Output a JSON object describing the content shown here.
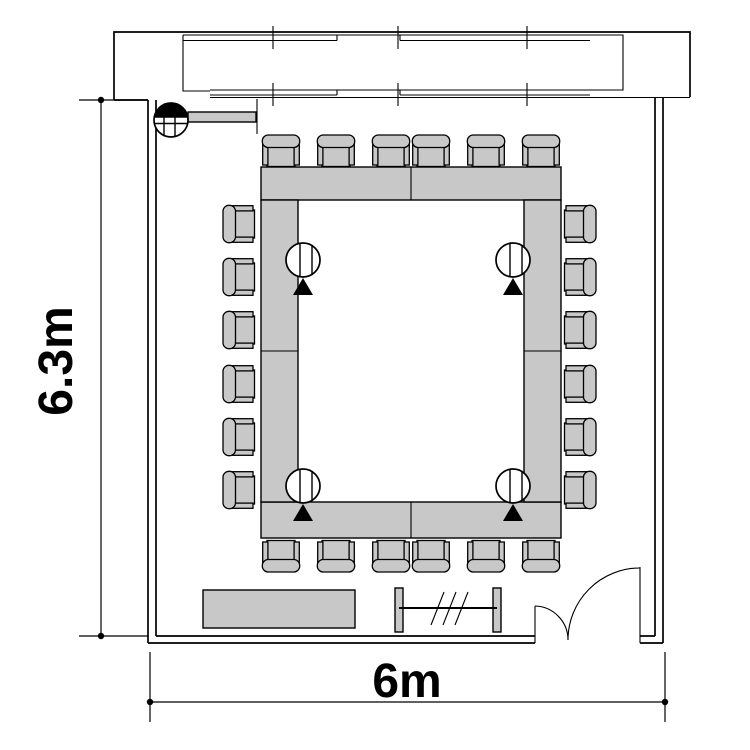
{
  "title": "Conference room floor plan",
  "dimension_labels": {
    "height": "6.3m",
    "width": "6m"
  },
  "plan": {
    "seat_count": 24,
    "table_sections": 8,
    "table_shape": "hollow rectangle",
    "microphone_symbol_count": 4,
    "door_position": "bottom right",
    "window_wall": "top",
    "sideboard_position": "bottom left"
  },
  "colors": {
    "line": "#000000",
    "furniture_fill": "#c8c8c8",
    "background": "#ffffff"
  }
}
